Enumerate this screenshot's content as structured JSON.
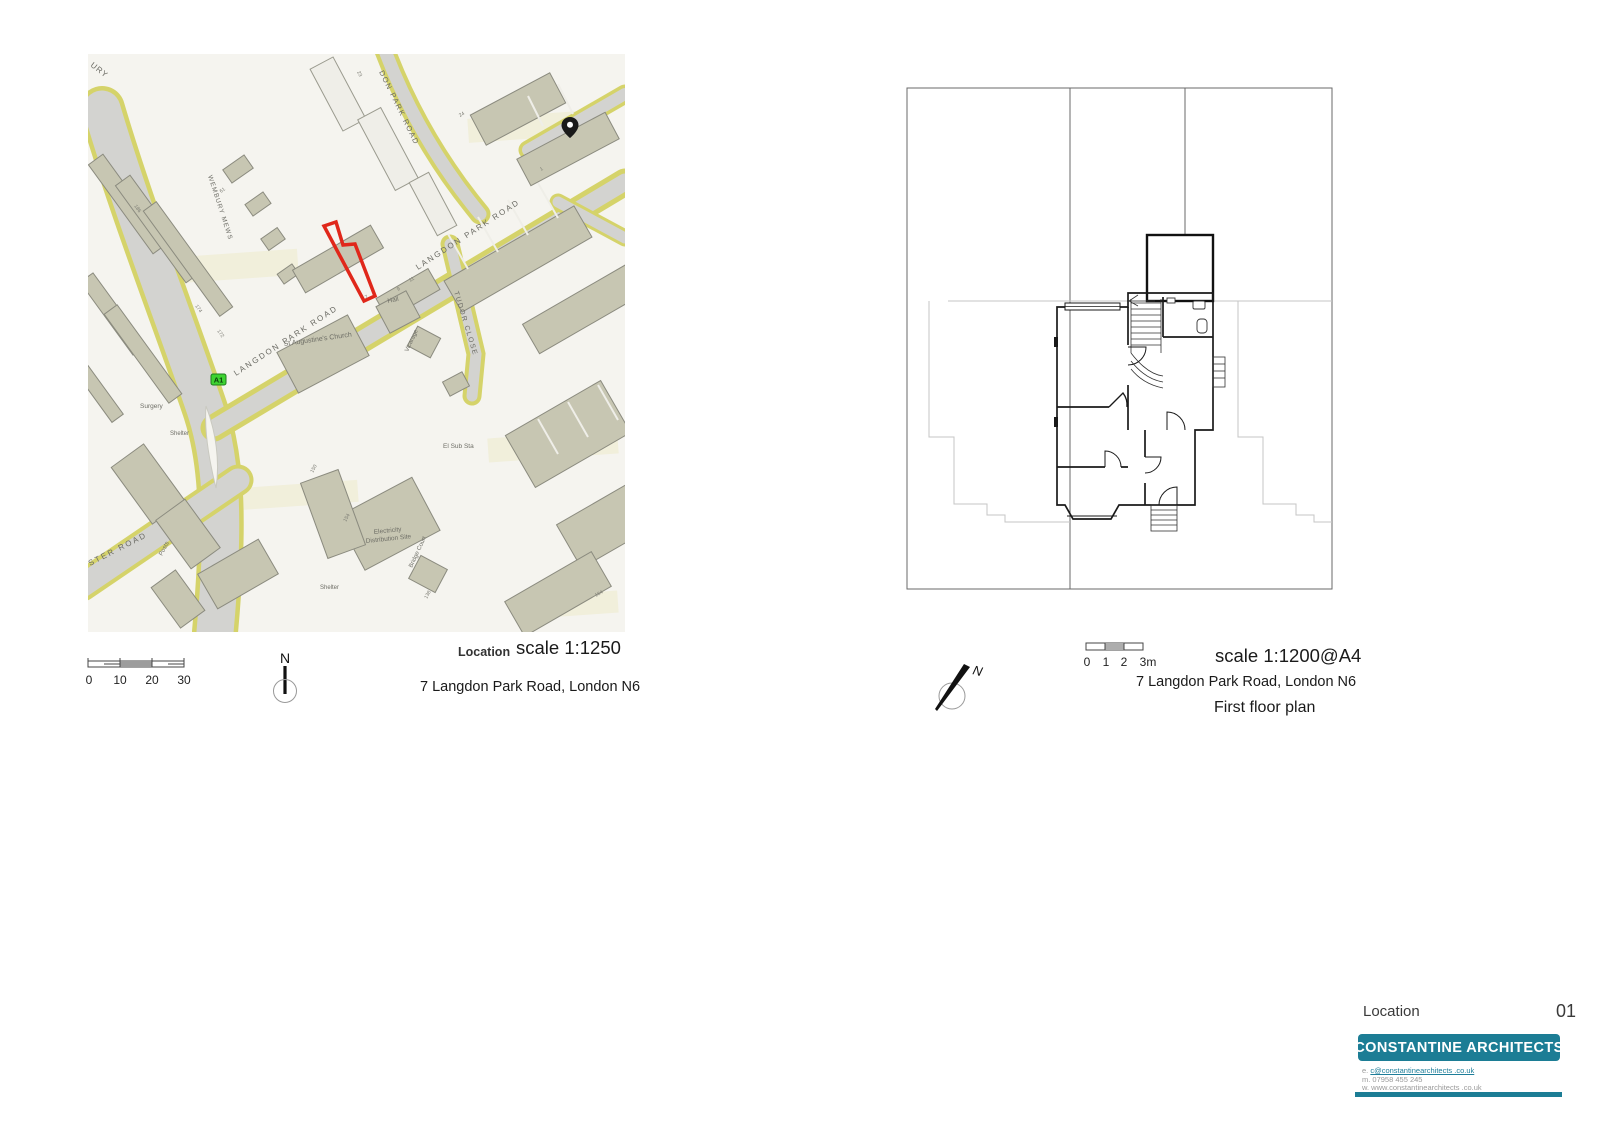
{
  "map_panel": {
    "street_labels": {
      "langdon_park_road": "LANGDON PARK ROAD",
      "langdon_park_road_top": "DON PARK ROAD",
      "tudor_close": "TUDOR CLOSE",
      "wembury_mews": "WEMBURY MEWS",
      "ster_road": "STER ROAD",
      "ury_fragment": "URY"
    },
    "place_labels": {
      "church": "St Augustine's Church",
      "hall": "Hall",
      "vicarage": "Vicarage",
      "el_sub_sta": "El Sub Sta",
      "electricity_line1": "Electricity",
      "electricity_line2": "Distribution Site",
      "shelter1": "Shelter",
      "shelter2": "Shelter",
      "surgery": "Surgery",
      "posts": "Posts",
      "bridge_court": "Bridge Court"
    },
    "road_badge": "A1",
    "house_numbers": [
      "186",
      "174",
      "172",
      "61",
      "24",
      "23",
      "7",
      "9",
      "11",
      "150",
      "154",
      "138",
      "164",
      "1"
    ],
    "colors": {
      "background": "#f5f4ef",
      "building": "#c7c6b2",
      "building_outline": "#8b8b7f",
      "road": "#d3d3d0",
      "road_edge": "#d5d36a",
      "site_outline": "#e0271a",
      "badge_green": "#3ed331"
    },
    "scale_bar": {
      "labels": [
        "0",
        "10",
        "20",
        "30"
      ]
    },
    "north_label": "N",
    "caption_label": "Location",
    "caption_scale": "scale 1:1250",
    "caption_address": "7 Langdon Park Road, London N6"
  },
  "plan_panel": {
    "scale_bar": {
      "labels": [
        "0",
        "1",
        "2",
        "3m"
      ]
    },
    "north_label": "N",
    "caption_scale": "scale 1:1200@A4",
    "caption_address": "7 Langdon Park Road, London N6",
    "caption_title": "First floor plan"
  },
  "title_block": {
    "sheet_name": "Location",
    "sheet_number": "01",
    "firm_name": "CONSTANTINE ARCHITECTS",
    "email_prefix": "e. ",
    "email": "c@constantinearchitects .co.uk",
    "mobile": "m. 07958 455 245",
    "website": "w. www.constantinearchitects .co.uk",
    "accent_color": "#1c7d95"
  }
}
